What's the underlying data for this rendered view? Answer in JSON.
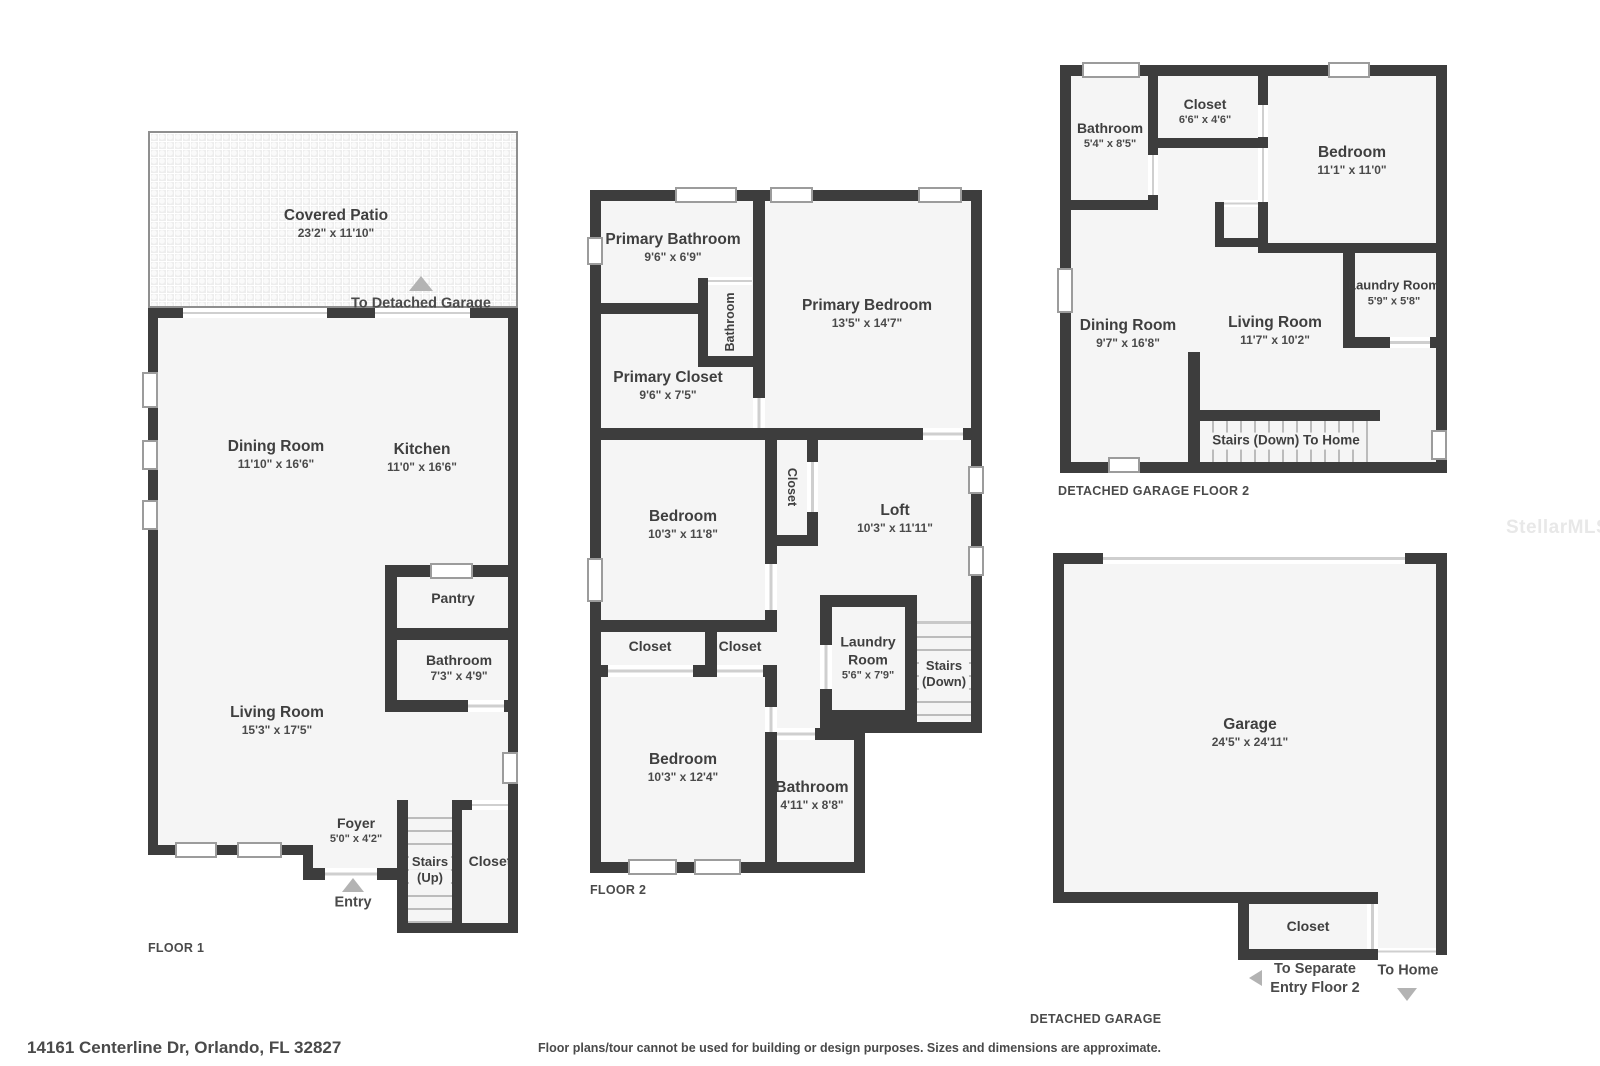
{
  "colors": {
    "wall": "#3d3d3d",
    "room_fill": "#f5f5f5",
    "text": "#3f3f3f",
    "muted_text": "#4a4a4a",
    "arrow": "#b3b3b3",
    "window_outline": "#9c9c9c"
  },
  "footer": {
    "address": "14161 Centerline Dr, Orlando, FL 32827",
    "disclaimer": "Floor plans/tour cannot be used for building or design purposes. Sizes and dimensions are approximate.",
    "watermark": "StellarMLS"
  },
  "floor1": {
    "caption": "FLOOR 1",
    "patio": {
      "name": "Covered Patio",
      "dims": "23'2\" x 11'10\""
    },
    "to_detached_garage": "To Detached Garage",
    "dining": {
      "name": "Dining Room",
      "dims": "11'10\" x 16'6\""
    },
    "kitchen": {
      "name": "Kitchen",
      "dims": "11'0\" x 16'6\""
    },
    "pantry": {
      "name": "Pantry"
    },
    "bathroom": {
      "name": "Bathroom",
      "dims": "7'3\" x 4'9\""
    },
    "living": {
      "name": "Living Room",
      "dims": "15'3\" x 17'5\""
    },
    "foyer": {
      "name": "Foyer",
      "dims": "5'0\" x 4'2\""
    },
    "stairs": {
      "line1": "Stairs",
      "line2": "(Up)"
    },
    "closet": {
      "name": "Closet"
    },
    "entry": "Entry"
  },
  "floor2": {
    "caption": "FLOOR 2",
    "primary_bathroom": {
      "name": "Primary Bathroom",
      "dims": "9'6\" x 6'9\""
    },
    "hall_bathroom": {
      "name": "Bathroom"
    },
    "primary_bedroom": {
      "name": "Primary Bedroom",
      "dims": "13'5\" x 14'7\""
    },
    "primary_closet": {
      "name": "Primary Closet",
      "dims": "9'6\" x 7'5\""
    },
    "bedroom1": {
      "name": "Bedroom",
      "dims": "10'3\" x 11'8\""
    },
    "loft_closet": {
      "name": "Closet"
    },
    "loft": {
      "name": "Loft",
      "dims": "10'3\" x 11'11\""
    },
    "closet1": {
      "name": "Closet"
    },
    "closet2": {
      "name": "Closet"
    },
    "laundry": {
      "name": "Laundry Room",
      "dims": "5'6\" x 7'9\""
    },
    "stairs": {
      "line1": "Stairs",
      "line2": "(Down)"
    },
    "bedroom2": {
      "name": "Bedroom",
      "dims": "10'3\" x 12'4\""
    },
    "bathroom2": {
      "name": "Bathroom",
      "dims": "4'11\" x 8'8\""
    }
  },
  "garage_floor2": {
    "caption": "DETACHED GARAGE FLOOR 2",
    "bathroom": {
      "name": "Bathroom",
      "dims": "5'4\" x 8'5\""
    },
    "closet": {
      "name": "Closet",
      "dims": "6'6\" x 4'6\""
    },
    "bedroom": {
      "name": "Bedroom",
      "dims": "11'1\" x 11'0\""
    },
    "dining": {
      "name": "Dining Room",
      "dims": "9'7\" x 16'8\""
    },
    "living": {
      "name": "Living Room",
      "dims": "11'7\" x 10'2\""
    },
    "laundry": {
      "name": "Laundry Room",
      "dims": "5'9\" x 5'8\""
    },
    "stairs": "Stairs (Down) To Home"
  },
  "garage": {
    "caption": "DETACHED GARAGE",
    "garage": {
      "name": "Garage",
      "dims": "24'5\" x 24'11\""
    },
    "closet": {
      "name": "Closet"
    },
    "to_separate_entry": {
      "line1": "To Separate",
      "line2": "Entry Floor 2"
    },
    "to_home": "To Home"
  }
}
